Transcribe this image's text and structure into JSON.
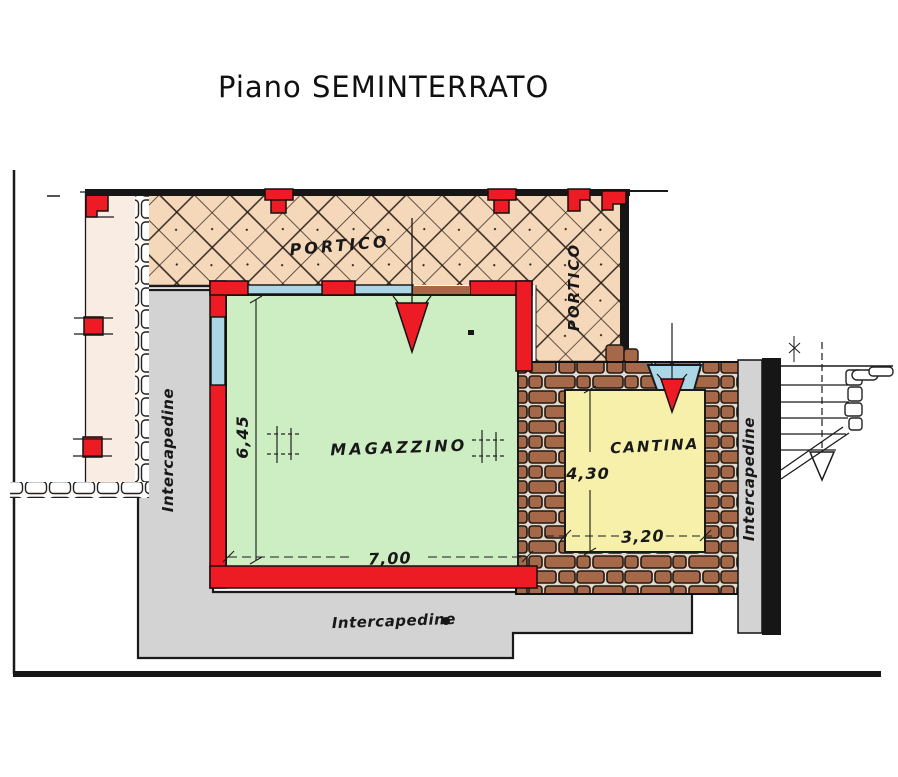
{
  "title": "Piano SEMINTERRATO",
  "rooms": {
    "portico_top": {
      "label": "PORTICO"
    },
    "portico_side": {
      "label": "PORTICO"
    },
    "magazzino": {
      "label": "MAGAZZINO"
    },
    "cantina": {
      "label": "CANTINA"
    }
  },
  "dimensions": {
    "magazzino_height": "6,45",
    "magazzino_width": "7,00",
    "cantina_height": "4,30",
    "cantina_width": "3,20"
  },
  "cavities": {
    "left": {
      "label": "Intercapedine"
    },
    "bottom": {
      "label": "Intercapedine"
    },
    "right": {
      "label": "Intercapedine"
    }
  },
  "colors": {
    "portico_fill": "#f5d7ba",
    "magazzino_fill": "#cdeec3",
    "cantina_fill": "#f6f0aa",
    "wall_red": "#ed1c24",
    "cavity_gray": "#d3d3d3",
    "stone_brown": "#a5694a",
    "window_blue": "#aad6e6",
    "foundation_cream": "#f8ece3",
    "line_black": "#1a1a1a"
  }
}
